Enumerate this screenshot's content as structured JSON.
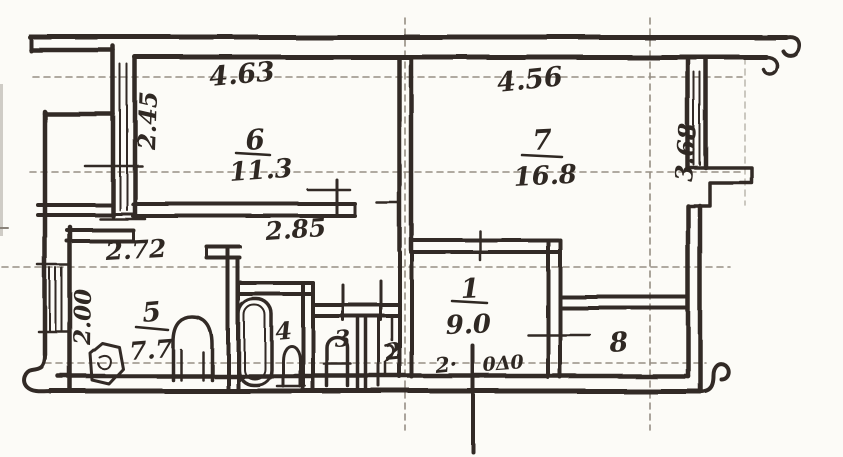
{
  "plan": {
    "paper_color": "#fcfbf7",
    "ink_color": "#332b25",
    "grid_color": "#7d7468",
    "rooms": {
      "room1": {
        "number": "1",
        "area": "9.0"
      },
      "room2": {
        "number": "2"
      },
      "room3": {
        "number": "3"
      },
      "room4": {
        "number": "4"
      },
      "room5": {
        "number": "5",
        "area": "7.7"
      },
      "room6": {
        "number": "6",
        "area": "11.3"
      },
      "room7": {
        "number": "7",
        "area": "16.8"
      },
      "room8": {
        "number": "8"
      }
    },
    "dimensions": {
      "room6_width": "4.63",
      "room6_depth": "2.45",
      "room7_width": "4.56",
      "room7_depth": "3.68",
      "hall_width": "2.85",
      "kitchen_width": "2.72",
      "kitchen_window": "2.00"
    },
    "entrance_note": {
      "left": "2·",
      "right": "0Δ0"
    }
  }
}
